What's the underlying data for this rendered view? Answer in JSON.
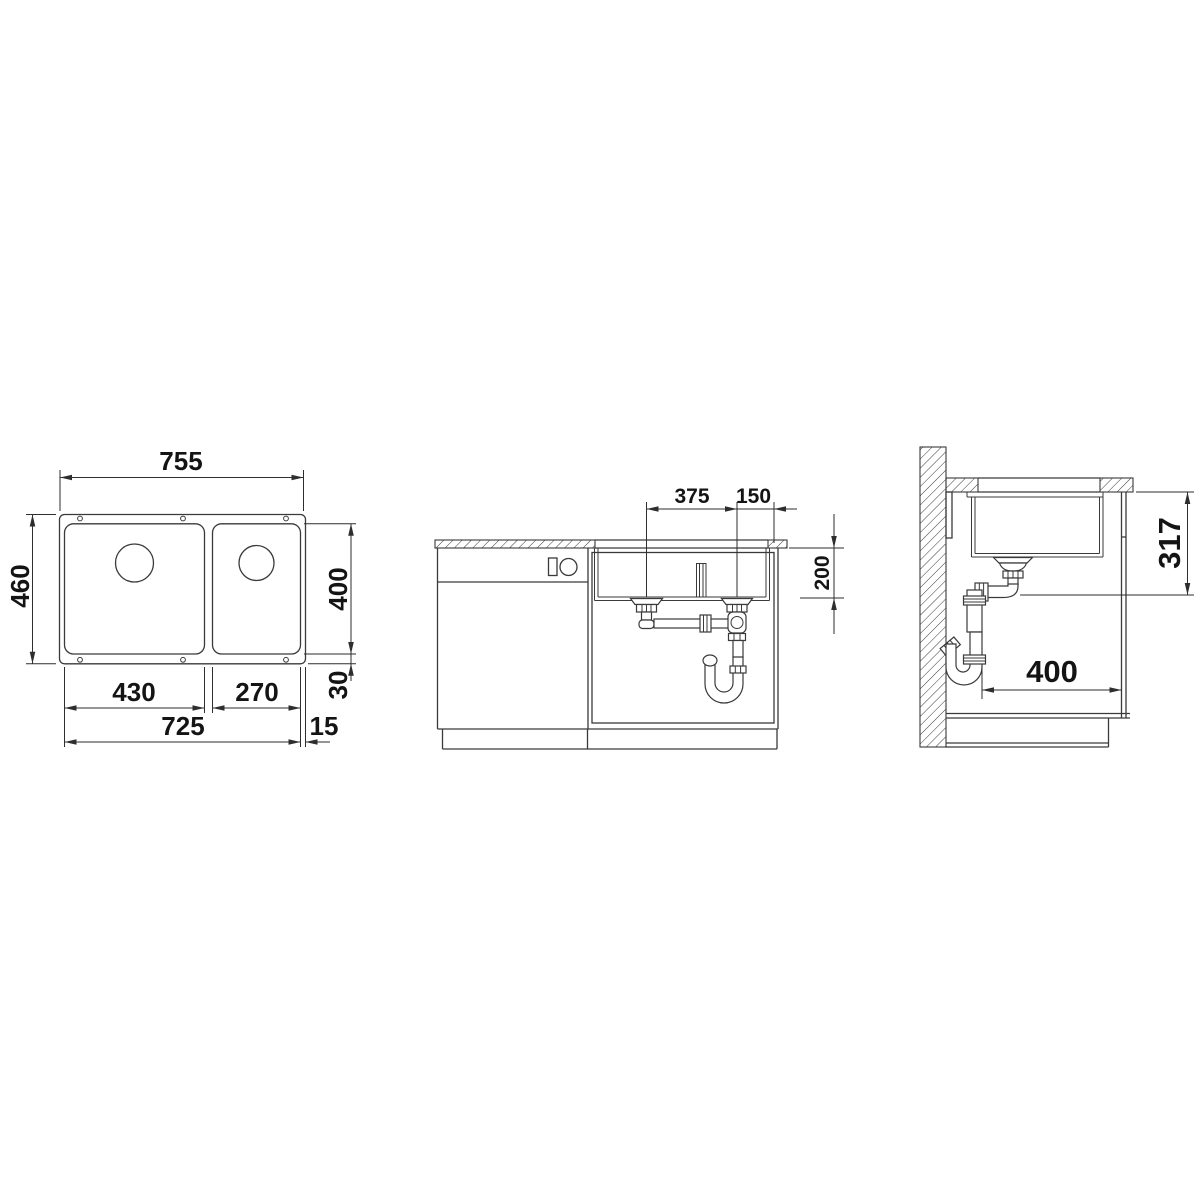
{
  "drawing": {
    "background": "#ffffff",
    "line_color": "#3a3a3a",
    "text_color": "#141414",
    "views": {
      "plan": {
        "label": "plan-view",
        "dims": {
          "overall_width": "755",
          "overall_depth": "460",
          "bowl_depth": "400",
          "rim_bottom": "30",
          "left_bowl_width": "430",
          "right_bowl_width": "270",
          "cutout_width": "725",
          "rim_right": "15"
        }
      },
      "front": {
        "label": "front-view",
        "dims": {
          "drain_spacing": "375",
          "drain_to_edge": "150",
          "bowl_height": "200"
        }
      },
      "side": {
        "label": "side-view",
        "dims": {
          "mount_height": "317",
          "clearance_depth": "400"
        }
      }
    }
  }
}
